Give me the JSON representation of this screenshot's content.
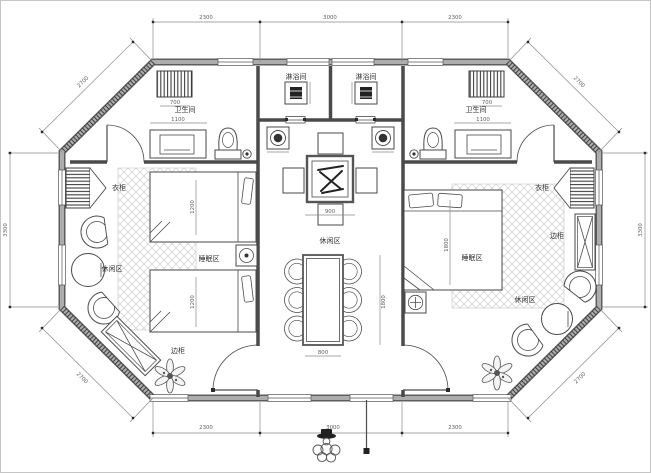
{
  "plan": {
    "rooms": {
      "shower_left": "淋浴间",
      "shower_right": "淋浴间",
      "bath_left": "卫生间",
      "bath_right": "卫生间",
      "wardrobe_left": "衣柜",
      "wardrobe_right": "衣柜",
      "cabinet_left": "边柜",
      "cabinet_right": "边柜",
      "leisure_left": "休闲区",
      "leisure_center": "休闲区",
      "leisure_right": "休闲区",
      "sleep_left": "睡眠区",
      "sleep_right": "睡眠区"
    },
    "dims": {
      "top_left": "2300",
      "top_mid": "3000",
      "top_right": "2300",
      "bottom_left": "2300",
      "bottom_mid": "3000",
      "bottom_right": "2300",
      "side_left": "3300",
      "side_right": "3300",
      "diag_tl": "2700",
      "diag_tr": "2700",
      "diag_bl": "2700",
      "diag_br": "2700",
      "bath_left_w": "1100",
      "bath_right_w": "1100",
      "unit_left": "700",
      "unit_right": "700",
      "tea_table_w": "900",
      "dining_h": "1800",
      "dining_w": "800",
      "bed_left_1": "1200",
      "bed_left_2": "1200",
      "bed_right_w": "1800"
    },
    "colors": {
      "wall_dark": "#5e5e5e",
      "wall_core": "#adadad",
      "line": "#444444",
      "dim_line": "#8a8a8a",
      "hatch": "#cfcfcf",
      "paper": "#ffffff"
    }
  }
}
